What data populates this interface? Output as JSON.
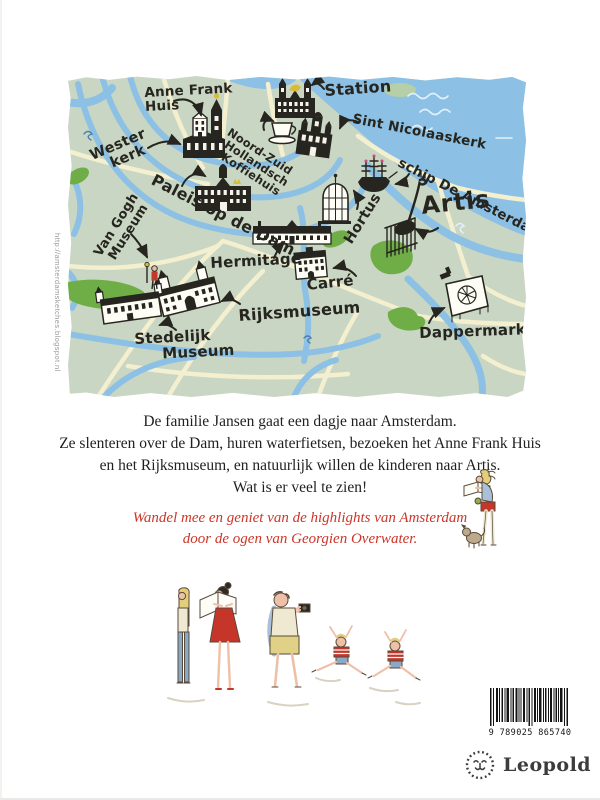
{
  "cover": {
    "publisher": "Leopold",
    "barcode_number": "9 789025 865740",
    "credit_url": "http://amsterdamsketches.blogspot.nl"
  },
  "map": {
    "colors": {
      "land": "#c8d6c3",
      "water": "#8cc0e4",
      "road": "#f3efcf",
      "park": "#6fae47",
      "ink": "#26251f"
    },
    "icons": [
      "station-building-icon",
      "sint-nicolaaskerk-building-icon",
      "westerkerk-building-icon",
      "anne-frank-huis-building-icon",
      "coffee-cup-icon",
      "paleis-op-de-dam-building-icon",
      "hermitage-building-icon",
      "carre-building-icon",
      "rijksmuseum-building-icon",
      "stedelijk-museum-building-icon",
      "van-gogh-figure-icon",
      "hortus-building-icon",
      "giraffe-icon",
      "ship-de-amsterdam-icon",
      "dappermarkt-stall-icon"
    ],
    "labels": [
      {
        "id": "anne-frank-huis",
        "text": "Anne Frank\nHuis"
      },
      {
        "id": "westerkerk",
        "text": "Wester\n   kerk"
      },
      {
        "id": "station",
        "text": "Station"
      },
      {
        "id": "sint-nicolaaskerk",
        "text": "Sint Nicolaaskerk"
      },
      {
        "id": "noord-zuid-hollandsch-koffiehuis",
        "text": "Noord-Zuid\n Hollandsch\n  Koffiehuis"
      },
      {
        "id": "paleis-op-de-dam",
        "text": "Paleis op de Dam"
      },
      {
        "id": "schip-de-amsterdam",
        "text": "schip De Amsterdam"
      },
      {
        "id": "artis",
        "text": "Artis"
      },
      {
        "id": "hortus",
        "text": "Hortus"
      },
      {
        "id": "van-gogh-museum",
        "text": "Van Gogh\n Museum"
      },
      {
        "id": "hermitage",
        "text": "Hermitage"
      },
      {
        "id": "carre",
        "text": "Carré"
      },
      {
        "id": "rijksmuseum",
        "text": "Rijksmuseum"
      },
      {
        "id": "stedelijk-museum",
        "text": "Stedelijk\n     Museum"
      },
      {
        "id": "dappermarkt",
        "text": "Dappermarkt"
      }
    ]
  },
  "blurb": {
    "lines": [
      "De familie Jansen gaat een dagje naar Amsterdam.",
      "Ze slenteren over de Dam, huren waterfietsen, bezoeken het Anne Frank Huis",
      "en het Rijksmuseum, en natuurlijk willen de kinderen naar Artis.",
      "Wat is er veel te zien!"
    ]
  },
  "tagline": {
    "color": "#cd3529",
    "lines": [
      "Wandel mee en geniet van de highlights van Amsterdam",
      "door de ogen van Georgien Overwater."
    ]
  }
}
